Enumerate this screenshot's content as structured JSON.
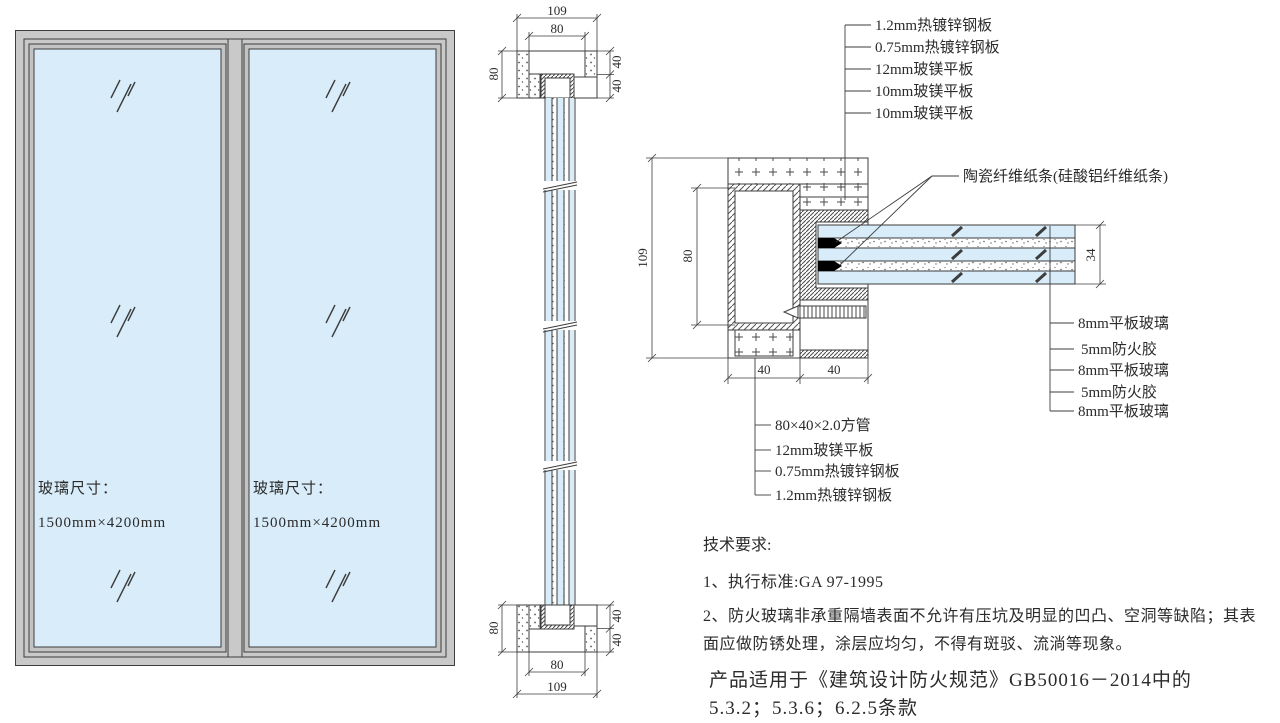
{
  "colors": {
    "glass": "#d8ecf9",
    "frame": "#c9c9c9",
    "line": "#3d3d3d",
    "fiber_strip": "#000000"
  },
  "elevation": {
    "panel1": {
      "size_title": "玻璃尺寸：",
      "size_value": "1500mm×4200mm"
    },
    "panel2": {
      "size_title": "玻璃尺寸：",
      "size_value": "1500mm×4200mm"
    }
  },
  "vertical_section": {
    "top": {
      "overall": "109",
      "inner": "80",
      "left": "80",
      "right_upper": "40",
      "right_lower": "40"
    },
    "bottom": {
      "overall": "109",
      "inner": "80",
      "left": "80",
      "right_upper": "40",
      "right_lower": "40"
    }
  },
  "detail": {
    "labels_top": [
      "1.2mm热镀锌钢板",
      "0.75mm热镀锌钢板",
      "12mm玻镁平板",
      "10mm玻镁平板",
      "10mm玻镁平板"
    ],
    "label_fiber": "陶瓷纤维纸条(硅酸铝纤维纸条)",
    "labels_right": [
      "8mm平板玻璃",
      "5mm防火胶",
      "8mm平板玻璃",
      "5mm防火胶",
      "8mm平板玻璃"
    ],
    "labels_bottom": [
      "80×40×2.0方管",
      "12mm玻镁平板",
      "0.75mm热镀锌钢板",
      "1.2mm热镀锌钢板"
    ],
    "dims": {
      "overall_height": "109",
      "tube_height": "80",
      "tube_width": "40",
      "panel_width": "40",
      "glass_thickness": "34"
    }
  },
  "notes": {
    "title": "技术要求:",
    "item1": "1、执行标准:GA 97-1995",
    "item2": "2、防火玻璃非承重隔墙表面不允许有压坑及明显的凹凸、空洞等缺陷；其表面应做防锈处理，涂层应均匀，不得有斑驳、流淌等现象。",
    "applicability_line1": "产品适用于《建筑设计防火规范》GB50016－2014中的",
    "applicability_line2": "5.3.2；5.3.6；6.2.5条款"
  }
}
